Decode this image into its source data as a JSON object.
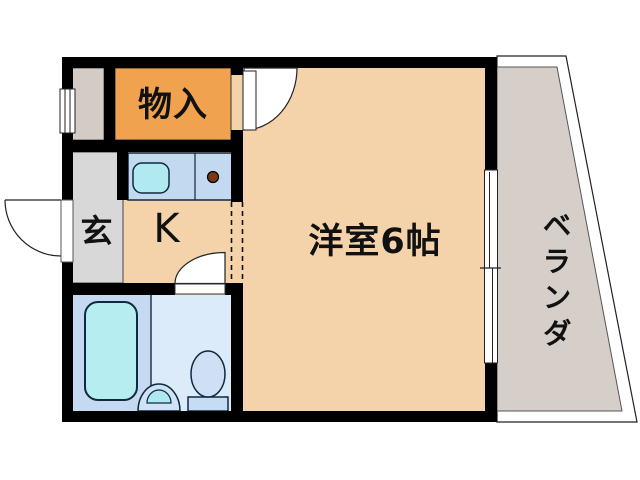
{
  "floorplan": {
    "type": "japanese-apartment-floor-plan",
    "labels": {
      "storage": "物入",
      "entry": "玄",
      "kitchen": "K",
      "main_room": "洋室6帖",
      "veranda": "ベランダ"
    },
    "fixtures": [
      "bathtub",
      "toilet",
      "wash-basin",
      "kitchen-sink",
      "gas-burner",
      "entrance-door",
      "storage-door",
      "bathroom-door",
      "sliding-window-left",
      "sliding-window-veranda"
    ],
    "colors": {
      "wall": "#000000",
      "floor": "#f4d3ab",
      "storage_room": "#f0a24f",
      "entry_floor": "#d8d8d8",
      "service_niche": "#d3ccc6",
      "veranda_floor": "#d6cec8",
      "kitchen_counter": "#c2d9f0",
      "sink_cyan": "#b0eaf0",
      "bathtub": "#b5edf0",
      "bath_floor_left": "#c5daf1",
      "bath_floor_right": "#dcebfa",
      "toilet": "#cfe0f4",
      "toilet_tank": "#c6dcf4",
      "basin_outer": "#cfe3f5",
      "gas_burner": "#7a3814",
      "background": "#ffffff"
    }
  }
}
